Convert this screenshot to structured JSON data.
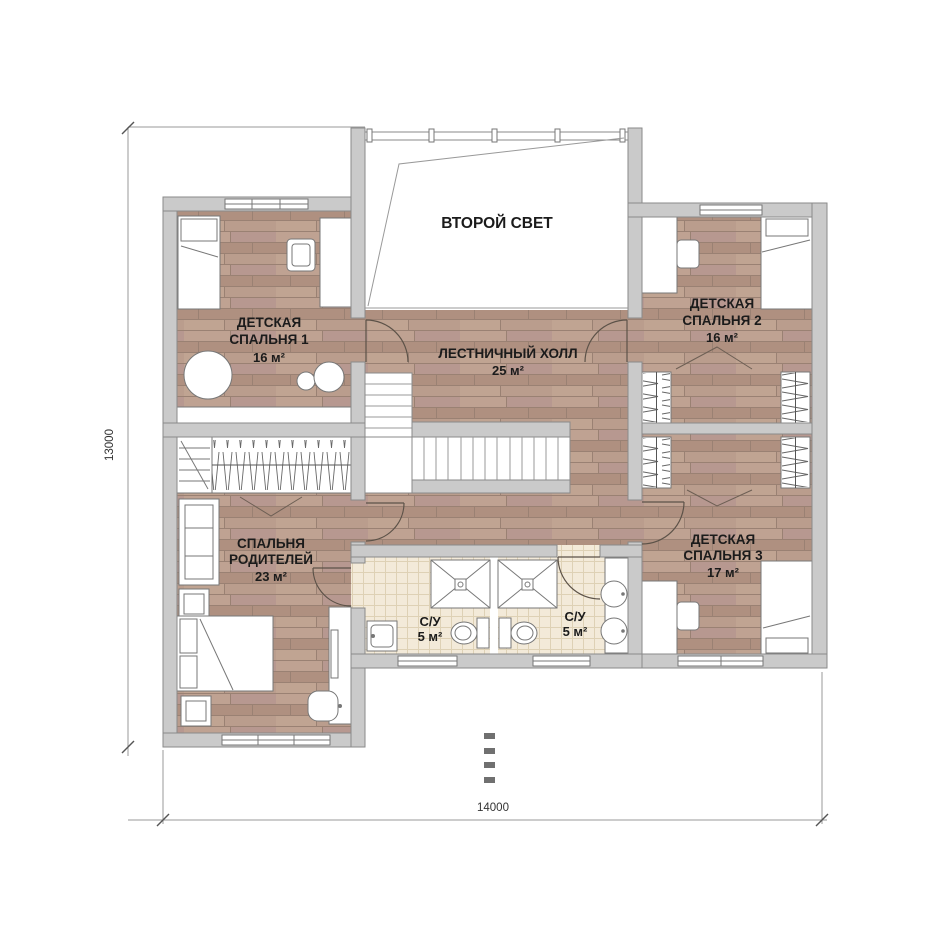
{
  "plan": {
    "rooms": {
      "second_light": {
        "label": "ВТОРОЙ СВЕТ"
      },
      "stair_hall": {
        "name": "ЛЕСТНИЧНЫЙ ХОЛЛ",
        "area": "25 м²"
      },
      "bedroom1": {
        "name_line1": "ДЕТСКАЯ",
        "name_line2": "СПАЛЬНЯ 1",
        "area": "16 м²"
      },
      "bedroom2": {
        "name_line1": "ДЕТСКАЯ",
        "name_line2": "СПАЛЬНЯ 2",
        "area": "16 м²"
      },
      "bedroom3": {
        "name_line1": "ДЕТСКАЯ",
        "name_line2": "СПАЛЬНЯ 3",
        "area": "17 м²"
      },
      "parents_bedroom": {
        "name_line1": "СПАЛЬНЯ",
        "name_line2": "РОДИТЕЛЕЙ",
        "area": "23 м²"
      },
      "bathroom_left": {
        "name": "С/У",
        "area": "5 м²"
      },
      "bathroom_right": {
        "name": "С/У",
        "area": "5 м²"
      }
    },
    "dimensions": {
      "left_vertical": "13000",
      "bottom_horizontal": "14000"
    },
    "colors": {
      "wall_fill": "#cacaca",
      "wall_stroke": "#8a8a8a",
      "wood_floor": "#b5978a",
      "tile_floor": "#f3ead9",
      "label_text": "#1b1b1b",
      "dimension_text": "#333333"
    }
  }
}
